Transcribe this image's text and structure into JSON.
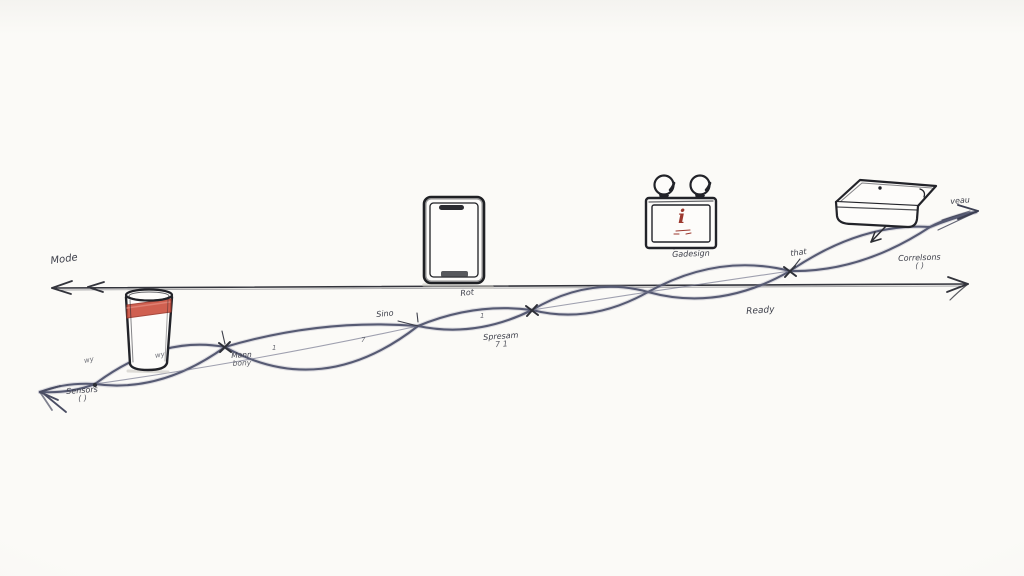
{
  "scene": {
    "description": "Hand-drawn sketch timeline of devices connected by braided wavy cables",
    "background_color": "#fbfaf7",
    "ink_color": "#26272c",
    "wave_color": "#5a5d77",
    "accent_red": "#c8503c",
    "objects": [
      "water-glass-with-red-band",
      "smartphone",
      "radio-with-earbud-knobs",
      "closed-laptop"
    ]
  },
  "labels": {
    "mode": "Mode",
    "sensors_line1": "Sensors",
    "sensors_line2": "( )",
    "knot_note_line1": "Mann",
    "knot_note_line2": "bony",
    "sino": "Sino",
    "rot": "Rot",
    "spresam_line1": "Spresam",
    "spresam_line2": "7 1",
    "gadesign": "Gadesign",
    "ready": "Ready",
    "that": "that",
    "correlsons_line1": "Correlsons",
    "correlsons_line2": "( )",
    "veau": "veau",
    "device_glyph": "i",
    "tick_wy1": "wy",
    "tick_wy2": "wy",
    "tick_1a": "1",
    "tick_1b": "1",
    "tick_7": "7"
  }
}
